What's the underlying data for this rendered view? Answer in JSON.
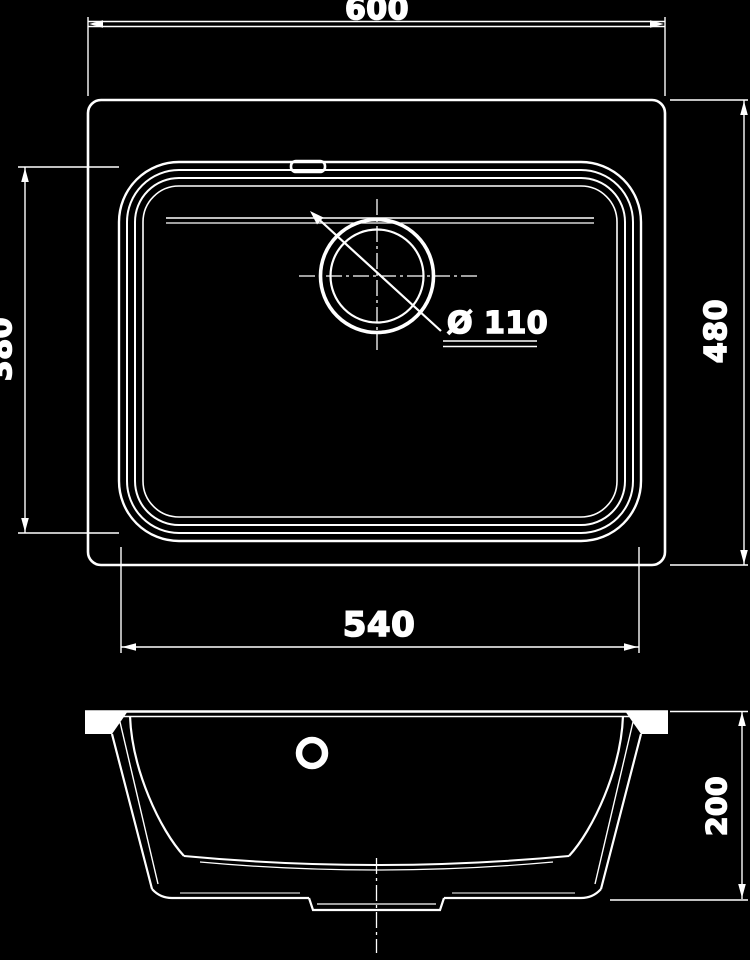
{
  "colors": {
    "background": "#000000",
    "line": "#ffffff"
  },
  "dimensions": {
    "overall_width": "600",
    "overall_depth": "480",
    "bowl_depth": "380",
    "bowl_width": "540",
    "bowl_height": "200",
    "drain_diameter": "Ø 110"
  }
}
